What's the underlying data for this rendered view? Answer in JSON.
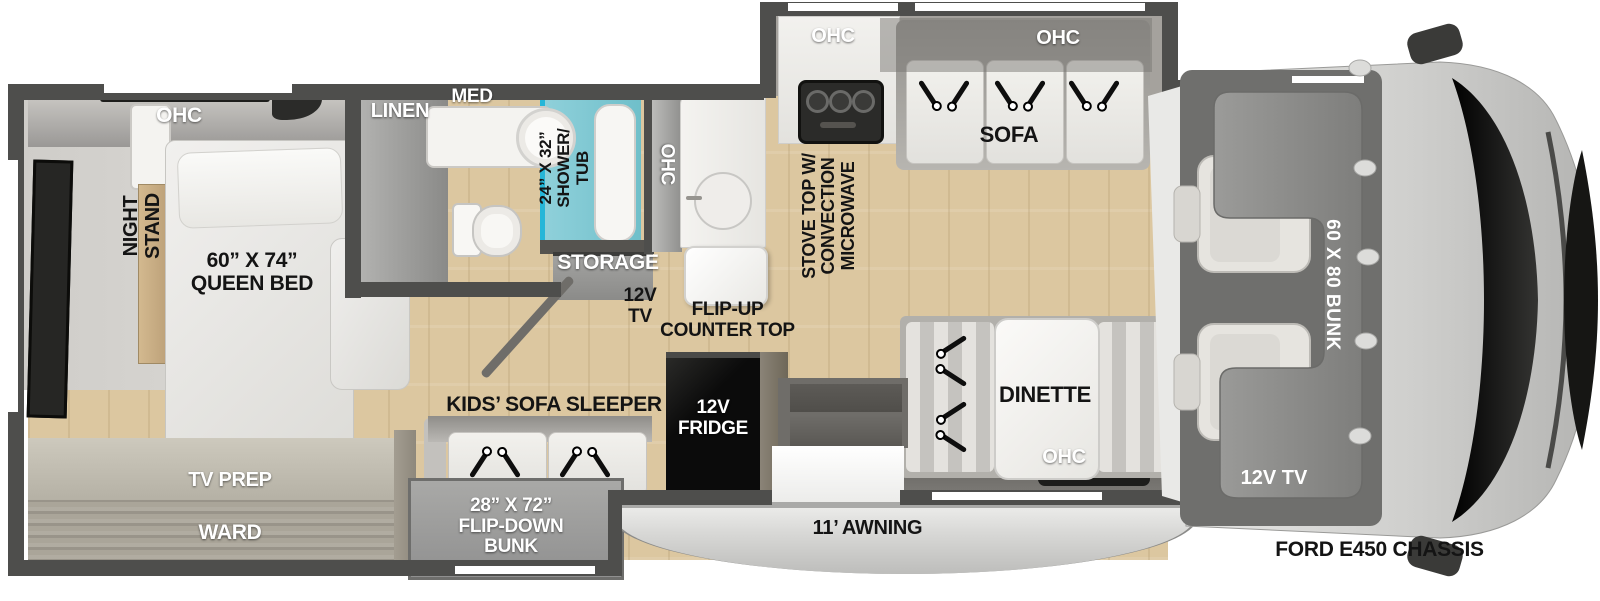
{
  "colors": {
    "wall": "#4e4e4c",
    "floor_wood": "#dcc7a0",
    "carpet": "#d7d5d1",
    "cushion_white": "#eeede9",
    "shower_teal": "#7cc5d0",
    "shower_accent": "#25b6d8",
    "fridge_black": "#0d0d0d",
    "overcab_bunk_gray": "#8d8d8b",
    "cab_body_gray": "#d9d9d7",
    "awning_gray": "#d4d4d2",
    "label_black": "#141414",
    "label_white": "#ffffff"
  },
  "labels": {
    "bedroom": {
      "ohc": "OHC",
      "night_stand": "NIGHT\nSTAND",
      "queen_bed": "60” X 74”\nQUEEN BED"
    },
    "wardrobe": {
      "tv_prep": "TV PREP",
      "ward": "WARD"
    },
    "bathroom": {
      "linen": "LINEN",
      "med": "MED",
      "shower_tub": "24” X 32”\nSHOWER/\nTUB"
    },
    "hallway": {
      "storage": "STORAGE",
      "tv": "12V\nTV",
      "flip_up_counter": "FLIP-UP\nCOUNTER TOP"
    },
    "kitchen": {
      "ohc_side": "OHC",
      "ohc_top": "OHC",
      "stove": "STOVE TOP W/\nCONVECTION\nMICROWAVE"
    },
    "sofa_area": {
      "ohc": "OHC",
      "sofa": "SOFA"
    },
    "dinette_area": {
      "dinette": "DINETTE",
      "ohc": "OHC"
    },
    "bunks": {
      "kids_sofa": "KIDS’ SOFA SLEEPER",
      "flip_down": "28” X 72”\nFLIP-DOWN\nBUNK"
    },
    "appliances": {
      "fridge": "12V\nFRIDGE"
    },
    "exterior": {
      "awning": "11’ AWNING"
    },
    "cab": {
      "bunk": "60 X 80 BUNK",
      "tv": "12V TV",
      "chassis": "FORD E450 CHASSIS"
    }
  }
}
